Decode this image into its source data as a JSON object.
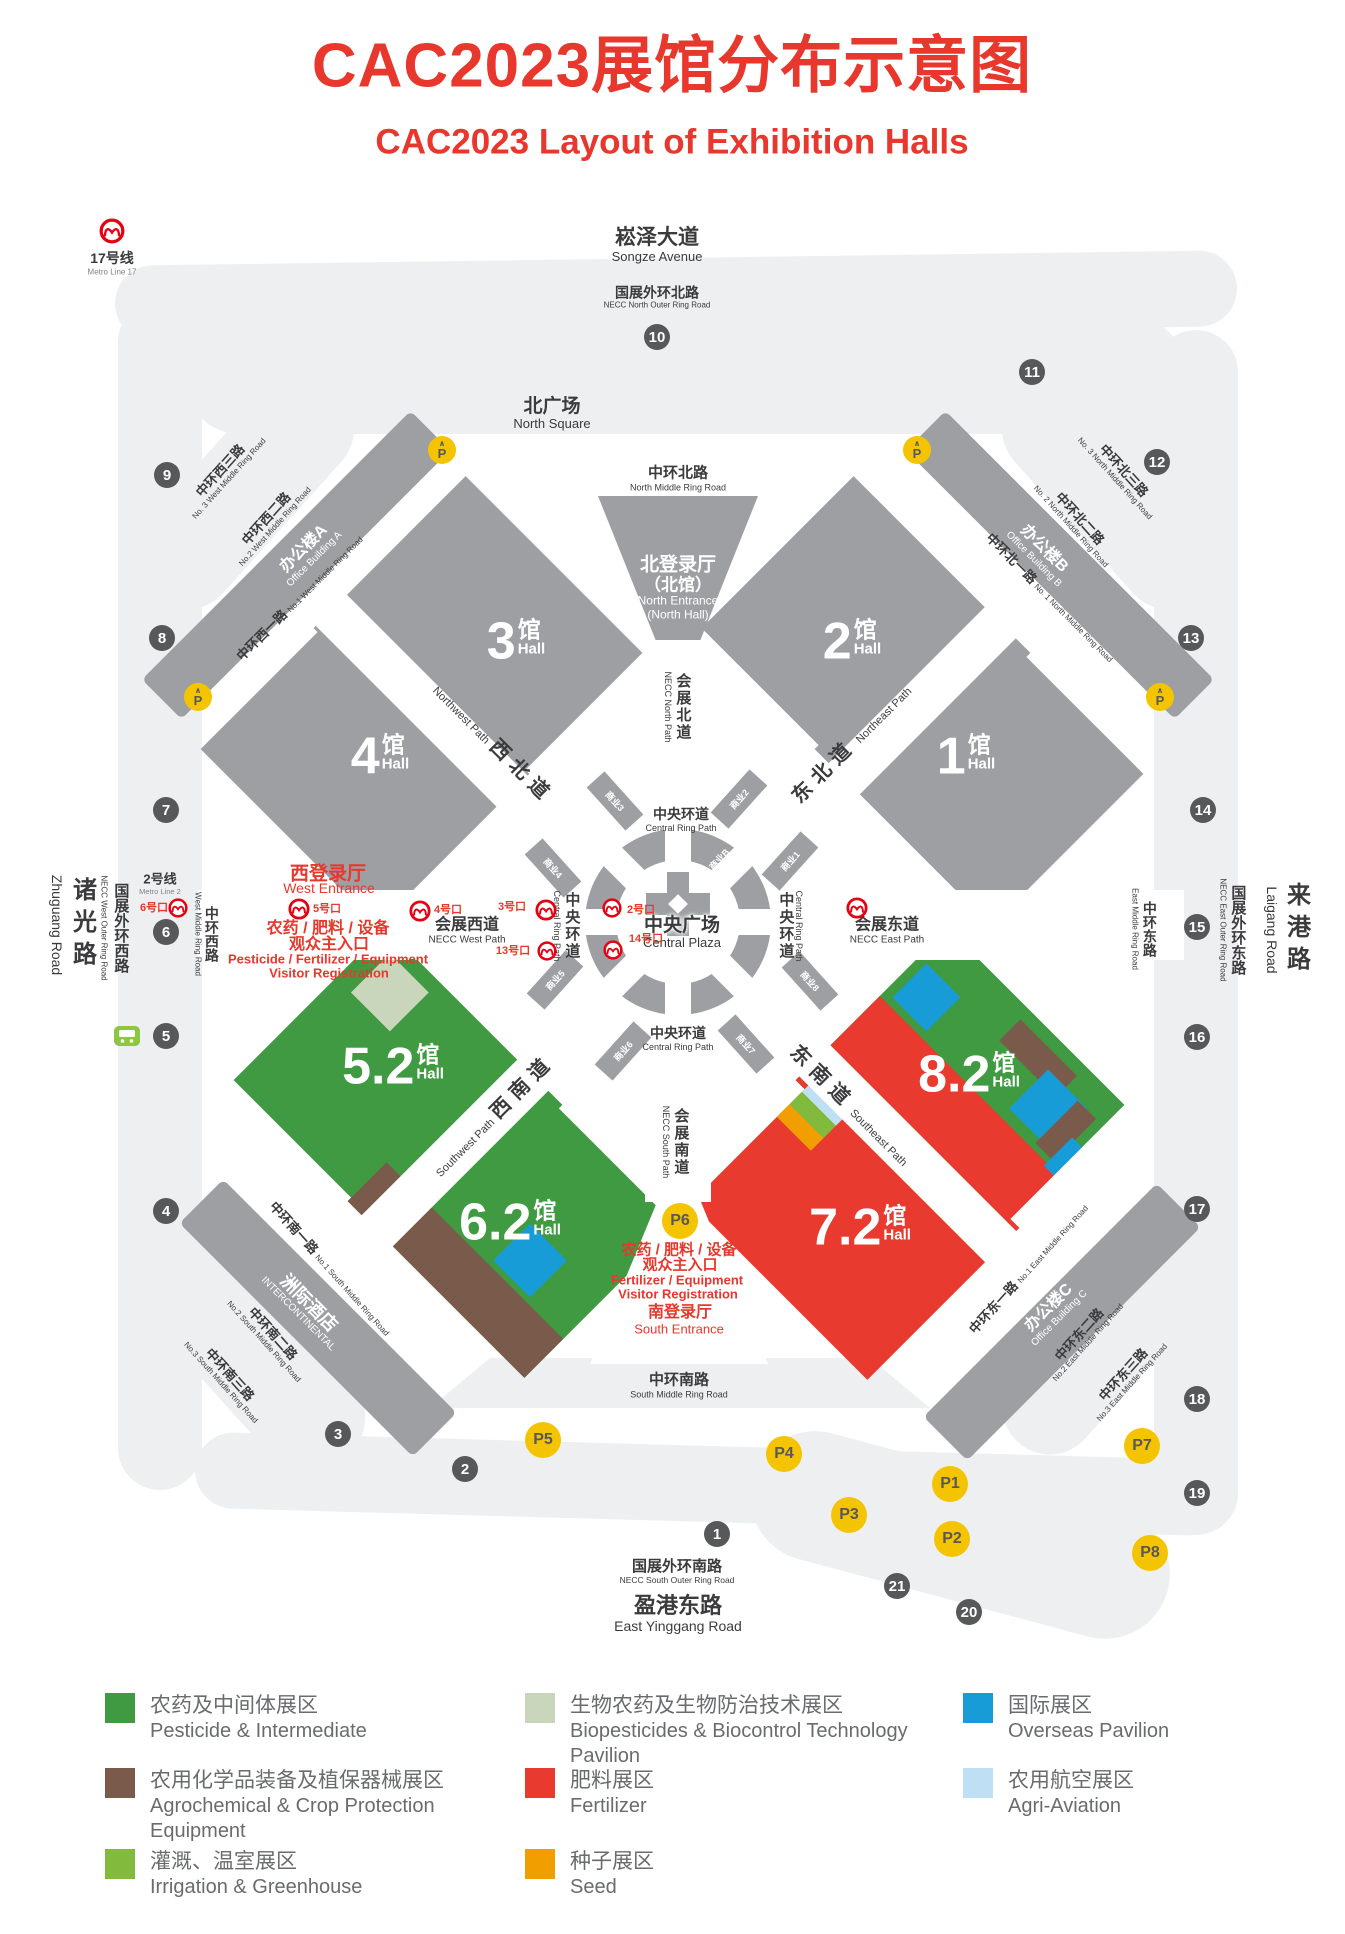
{
  "title": {
    "cjk": "CAC2023展馆分布示意图",
    "en": "CAC2023 Layout of Exhibition Halls"
  },
  "colors": {
    "title_red": "#e8372c",
    "metro_red": "#e60012",
    "gate_gray": "#57585a",
    "parking_yellow": "#f5c400",
    "hall_gray": "#9d9fa2",
    "registration_red": "#e8372c",
    "bus_green": "#8dc63f"
  },
  "halls": {
    "suffix_cjk": "馆",
    "suffix_en": "Hall",
    "h1": {
      "num": "1"
    },
    "h2": {
      "num": "2"
    },
    "h3": {
      "num": "3"
    },
    "h4": {
      "num": "4"
    },
    "h52": {
      "num": "5.2"
    },
    "h62": {
      "num": "6.2"
    },
    "h72": {
      "num": "7.2"
    },
    "h82": {
      "num": "8.2"
    }
  },
  "entrances": {
    "north": {
      "cjk1": "北登录厅",
      "cjk2": "（北馆）",
      "en1": "North Entrance",
      "en2": "(North Hall)"
    },
    "west": {
      "cjk": "西登录厅",
      "en": "West Entrance"
    },
    "south": {
      "cjk": "南登录厅",
      "en": "South Entrance"
    }
  },
  "registration": {
    "west": {
      "l1": "农药 / 肥料 / 设备",
      "l2": "观众主入口",
      "l3": "Pesticide / Fertilizer / Equipment",
      "l4": "Visitor Registration"
    },
    "south": {
      "l1": "农药 / 肥料 / 设备",
      "l2": "观众主入口",
      "l3": "Fertilizer / Equipment",
      "l4": "Visitor Registration"
    }
  },
  "metro": {
    "line17": {
      "cjk": "17号线",
      "en": "Metro Line 17"
    },
    "line2": {
      "cjk": "2号线",
      "en": "Metro Line 2"
    },
    "exits": {
      "e2": "2号口",
      "e3": "3号口",
      "e4": "4号口",
      "e5": "5号口",
      "e6": "6号口",
      "e13": "13号口",
      "e14": "14号口"
    }
  },
  "roads": {
    "songze": {
      "cjk": "崧泽大道",
      "en": "Songze Avenue"
    },
    "necc_north_outer": {
      "cjk": "国展外环北路",
      "en": "NECC North Outer Ring Road"
    },
    "north_square": {
      "cjk": "北广场",
      "en": "North Square"
    },
    "north_middle": {
      "cjk": "中环北路",
      "en": "North Middle Ring Road"
    },
    "west3": {
      "cjk": "中环西三路",
      "en": "No. 3 West Middle Ring Road"
    },
    "west2": {
      "cjk": "中环西二路",
      "en": "No.2 West Middle Ring Road"
    },
    "west1": {
      "cjk": "中环西一路",
      "en": "No.1 West Middle Ring Road"
    },
    "north3": {
      "cjk": "中环北三路",
      "en": "No. 3 North Middle Ring Road"
    },
    "north2": {
      "cjk": "中环北二路",
      "en": "No. 2 North Middle Ring Road"
    },
    "north1": {
      "cjk": "中环北一路",
      "en": "No. 1 North Middle Ring Road"
    },
    "zhuguang": {
      "cjk": "诸光路",
      "en": "Zhuguang Road"
    },
    "necc_west_outer": {
      "cjk": "国展外环西路",
      "en": "NECC West Outer Ring Road"
    },
    "west_middle": {
      "cjk": "中环西路",
      "en": "West Middle Ring Road"
    },
    "necc_north_path": {
      "cjk": "会展北道",
      "en": "NECC North Path"
    },
    "northwest_path": {
      "cjk": "西北道",
      "en": "Northwest Path"
    },
    "northeast_path": {
      "cjk": "东北道",
      "en": "Northeast Path"
    },
    "central_ring": {
      "cjk": "中央环道",
      "en": "Central Ring Path"
    },
    "central_plaza": {
      "cjk": "中央广场",
      "en": "Central Plaza"
    },
    "necc_west_path": {
      "cjk": "会展西道",
      "en": "NECC West Path"
    },
    "necc_east_path": {
      "cjk": "会展东道",
      "en": "NECC East Path"
    },
    "east_middle": {
      "cjk": "中环东路",
      "en": "East Middle Ring Road"
    },
    "necc_east_outer": {
      "cjk": "国展外环东路",
      "en": "NECC East Outer Ring Road"
    },
    "laigang": {
      "cjk": "来港路",
      "en": "Laigang Road"
    },
    "southwest_path": {
      "cjk": "西南道",
      "en": "Southwest Path"
    },
    "southeast_path": {
      "cjk": "东南道",
      "en": "Southeast Path"
    },
    "necc_south_path": {
      "cjk": "会展南道",
      "en": "NECC South Path"
    },
    "south1": {
      "cjk": "中环南一路",
      "en": "No.1 South Middle Ring Road"
    },
    "south2": {
      "cjk": "中环南二路",
      "en": "No.2 South Middle Ring Road"
    },
    "south3": {
      "cjk": "中环南三路",
      "en": "No.3 South Middle Ring Road"
    },
    "east1": {
      "cjk": "中环东一路",
      "en": "No.1 East Middle Ring Road"
    },
    "east2": {
      "cjk": "中环东二路",
      "en": "No.2 East Middle Ring Road"
    },
    "east3": {
      "cjk": "中环东三路",
      "en": "No.3 East Middle Ring Road"
    },
    "south_middle": {
      "cjk": "中环南路",
      "en": "South Middle Ring Road"
    },
    "necc_south_outer": {
      "cjk": "国展外环南路",
      "en": "NECC South Outer Ring Road"
    },
    "yinggang": {
      "cjk": "盈港东路",
      "en": "East Yinggang Road"
    }
  },
  "buildings": {
    "office_a": {
      "cjk": "办公楼A",
      "en": "Office Building A"
    },
    "office_b": {
      "cjk": "办公楼B",
      "en": "Office Building B"
    },
    "office_c": {
      "cjk": "办公楼C",
      "en": "Office Building C"
    },
    "hotel": {
      "cjk": "洲际酒店",
      "en": "INTERCONTINENTAL"
    }
  },
  "gates": [
    "1",
    "2",
    "3",
    "4",
    "5",
    "6",
    "7",
    "8",
    "9",
    "10",
    "11",
    "12",
    "13",
    "14",
    "15",
    "16",
    "17",
    "18",
    "19",
    "20",
    "21"
  ],
  "parking": [
    "P1",
    "P2",
    "P3",
    "P4",
    "P5",
    "P6",
    "P7",
    "P8"
  ],
  "parking_symbol": "P",
  "biz": {
    "b1": "商业1",
    "b2": "商业2",
    "b3": "商业3",
    "b4": "商业4",
    "b5": "商业5",
    "b6": "商业6",
    "b7": "商业7",
    "b8": "商业8",
    "bA": "商业A",
    "bB": "商业B",
    "bC": "商业C",
    "bD": "商业D"
  },
  "legend": [
    {
      "cjk": "农药及中间体展区",
      "en": "Pesticide & Intermediate",
      "color": "#3f9a41"
    },
    {
      "cjk": "农用化学品装备及植保器械展区",
      "en": "Agrochemical & Crop Protection Equipment",
      "color": "#7a5b4b"
    },
    {
      "cjk": "灌溉、温室展区",
      "en": "Irrigation & Greenhouse",
      "color": "#82ba3e"
    },
    {
      "cjk": "生物农药及生物防治技术展区",
      "en": "Biopesticides & Biocontrol Technology Pavilion",
      "color": "#c9d6bc"
    },
    {
      "cjk": "肥料展区",
      "en": "Fertilizer",
      "color": "#e83a2e"
    },
    {
      "cjk": "种子展区",
      "en": "Seed",
      "color": "#f09e00"
    },
    {
      "cjk": "国际展区",
      "en": "Overseas Pavilion",
      "color": "#189cd8"
    },
    {
      "cjk": "农用航空展区",
      "en": "Agri-Aviation",
      "color": "#bfe0f4"
    }
  ]
}
